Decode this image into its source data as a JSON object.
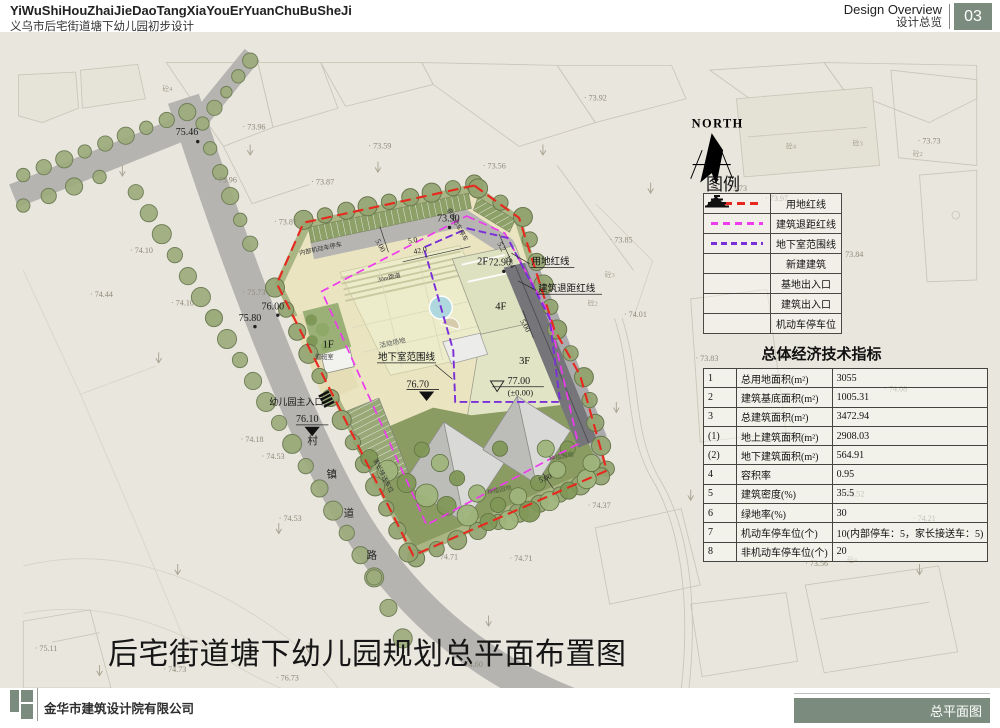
{
  "colors": {
    "accent": "#7b8c7e",
    "red_line": "#e8281e",
    "magenta_line": "#ee3bee",
    "purple_line": "#7a2fd8",
    "paper": "#e9e6de",
    "road": "#b5b4b0",
    "lawn": "#8b9c63",
    "yard": "#ebe4c1"
  },
  "header": {
    "title_pinyin": "YiWuShiHouZhaiJieDaoTangXiaYouErYuanChuBuSheJi",
    "title_cn": "义乌市后宅街道塘下幼儿园初步设计",
    "section_en": "Design Overview",
    "section_cn": "设计总览",
    "page_number": "03"
  },
  "map": {
    "north_label": "NORTH",
    "legend": {
      "title": "图例",
      "items": [
        {
          "symbol": "red-dashed",
          "label": "用地红线"
        },
        {
          "symbol": "magenta-dashed",
          "label": "建筑退距红线"
        },
        {
          "symbol": "purple-dashed",
          "label": "地下室范围线"
        },
        {
          "symbol": "building",
          "label": "新建建筑"
        },
        {
          "symbol": "site-entrance",
          "label": "基地出入口"
        },
        {
          "symbol": "building-entrance",
          "label": "建筑出入口"
        },
        {
          "symbol": "parking",
          "label": "机动车停车位"
        }
      ]
    },
    "indicators": {
      "title": "总体经济技术指标",
      "rows": [
        [
          "1",
          "总用地面积(m²)",
          "3055"
        ],
        [
          "2",
          "建筑基底面积(m²)",
          "1005.31"
        ],
        [
          "3",
          "总建筑面积(m²)",
          "3472.94"
        ],
        [
          "(1)",
          "地上建筑面积(m²)",
          "2908.03"
        ],
        [
          "(2)",
          "地下建筑面积(m²)",
          "564.91"
        ],
        [
          "4",
          "容积率",
          "0.95"
        ],
        [
          "5",
          "建筑密度(%)",
          "35.5"
        ],
        [
          "6",
          "绿地率(%)",
          "30"
        ],
        [
          "7",
          "机动车停车位(个)",
          "10(内部停车：5，家长接送车：5)"
        ],
        [
          "8",
          "非机动车停车位(个)",
          "20"
        ]
      ]
    },
    "plan_labels": [
      {
        "t": "75.46",
        "x": 160,
        "y": 108,
        "c": "elev"
      },
      {
        "t": "76.00",
        "x": 250,
        "y": 291,
        "c": "elev"
      },
      {
        "t": "75.80",
        "x": 226,
        "y": 303,
        "c": "elev"
      },
      {
        "t": "73.90",
        "x": 434,
        "y": 199,
        "c": "elev"
      },
      {
        "t": "72.90",
        "x": 488,
        "y": 245,
        "c": "elev"
      },
      {
        "t": "77.00",
        "x": 508,
        "y": 369,
        "c": "elev"
      },
      {
        "t": "(±0.00)",
        "x": 508,
        "y": 381,
        "c": "elev2"
      },
      {
        "t": "76.70",
        "x": 402,
        "y": 373,
        "c": "elev"
      },
      {
        "t": "76.10",
        "x": 286,
        "y": 409,
        "c": "elev"
      },
      {
        "t": "2F",
        "x": 476,
        "y": 244,
        "c": "floor"
      },
      {
        "t": "4F",
        "x": 495,
        "y": 291,
        "c": "floor"
      },
      {
        "t": "3F",
        "x": 520,
        "y": 348,
        "c": "floor"
      },
      {
        "t": "1F",
        "x": 314,
        "y": 331,
        "c": "floor"
      },
      {
        "t": "值班室",
        "x": 306,
        "y": 343,
        "c": "tiny"
      },
      {
        "t": "用地红线",
        "x": 533,
        "y": 244,
        "c": "ann"
      },
      {
        "t": "建筑退距红线",
        "x": 540,
        "y": 272,
        "c": "ann"
      },
      {
        "t": "地下室范围线",
        "x": 372,
        "y": 344,
        "c": "ann"
      },
      {
        "t": "幼儿园主入口",
        "x": 258,
        "y": 391,
        "c": "ann2"
      },
      {
        "t": "村",
        "x": 298,
        "y": 432,
        "c": "road"
      },
      {
        "t": "镇",
        "x": 318,
        "y": 467,
        "c": "road"
      },
      {
        "t": "道",
        "x": 336,
        "y": 508,
        "c": "road"
      },
      {
        "t": "路",
        "x": 360,
        "y": 552,
        "c": "road"
      },
      {
        "t": "内部机动车停车",
        "x": 290,
        "y": 234,
        "r": -12,
        "c": "tiny"
      },
      {
        "t": "非机动车停车",
        "x": 444,
        "y": 186,
        "r": 61,
        "c": "tiny"
      },
      {
        "t": "家长接送车位",
        "x": 367,
        "y": 449,
        "r": 63,
        "c": "tiny"
      },
      {
        "t": "30m跑道",
        "x": 372,
        "y": 262,
        "r": -12,
        "c": "tiny"
      },
      {
        "t": "活动场地",
        "x": 374,
        "y": 331,
        "r": -12,
        "c": "tiny2"
      },
      {
        "t": "种植园地",
        "x": 487,
        "y": 485,
        "r": -12,
        "c": "green"
      },
      {
        "t": "种植园地",
        "x": 552,
        "y": 450,
        "r": -12,
        "c": "green"
      },
      {
        "t": "5.00",
        "x": 369,
        "y": 219,
        "r": 61,
        "c": "dim"
      },
      {
        "t": "5.0",
        "x": 404,
        "y": 222,
        "r": -12,
        "c": "dim"
      },
      {
        "t": "42.0",
        "x": 410,
        "y": 233,
        "r": -12,
        "c": "dim"
      },
      {
        "t": "5.2",
        "x": 497,
        "y": 222,
        "r": 61,
        "c": "dim"
      },
      {
        "t": "17.4",
        "x": 505,
        "y": 236,
        "r": 61,
        "c": "dim"
      },
      {
        "t": "5.00",
        "x": 521,
        "y": 303,
        "r": 61,
        "c": "dim"
      },
      {
        "t": "5.00",
        "x": 542,
        "y": 473,
        "r": -23,
        "c": "dim"
      }
    ],
    "spot_elevations": [
      [
        362,
        122,
        "73.59"
      ],
      [
        588,
        72,
        "73.92"
      ],
      [
        302,
        160,
        "73.87"
      ],
      [
        263,
        202,
        "73.87"
      ],
      [
        230,
        102,
        "73.96"
      ],
      [
        200,
        158,
        "73.96"
      ],
      [
        112,
        232,
        "74.10"
      ],
      [
        155,
        287,
        "74.10"
      ],
      [
        70,
        278,
        "74.44"
      ],
      [
        230,
        276,
        "75.73"
      ],
      [
        250,
        448,
        "74.53"
      ],
      [
        268,
        513,
        "74.53"
      ],
      [
        228,
        430,
        "74.18"
      ],
      [
        432,
        553,
        "74.71"
      ],
      [
        510,
        555,
        "74.71"
      ],
      [
        592,
        499,
        "74.37"
      ],
      [
        615,
        221,
        "73.85"
      ],
      [
        630,
        299,
        "74.01"
      ],
      [
        903,
        377,
        "74.08"
      ],
      [
        933,
        513,
        "74.21"
      ],
      [
        798,
        427,
        "73.53"
      ],
      [
        858,
        487,
        "73.52"
      ],
      [
        785,
        343,
        "73.63"
      ],
      [
        705,
        345,
        "73.83"
      ],
      [
        820,
        560,
        "73.56"
      ],
      [
        735,
        167,
        "73.73"
      ],
      [
        778,
        177,
        "73.97"
      ],
      [
        857,
        236,
        "73.84"
      ],
      [
        482,
        143,
        "73.56"
      ],
      [
        12,
        649,
        "75.11"
      ],
      [
        147,
        671,
        "74.73"
      ],
      [
        265,
        680,
        "76.73"
      ],
      [
        458,
        666,
        "74.60"
      ],
      [
        938,
        117,
        "73.73"
      ]
    ],
    "bg_codes": [
      [
        800,
        122,
        "砼4"
      ],
      [
        870,
        119,
        "砼3"
      ],
      [
        933,
        130,
        "砼2"
      ],
      [
        610,
        257,
        "砼3"
      ],
      [
        592,
        287,
        "砼2"
      ],
      [
        864,
        556,
        "砼4"
      ],
      [
        146,
        62,
        "砼4"
      ]
    ]
  },
  "main_title": "后宅街道塘下幼儿园规划总平面布置图",
  "footer": {
    "company": "金华市建筑设计院有限公司",
    "sheet_name": "总平面图"
  }
}
